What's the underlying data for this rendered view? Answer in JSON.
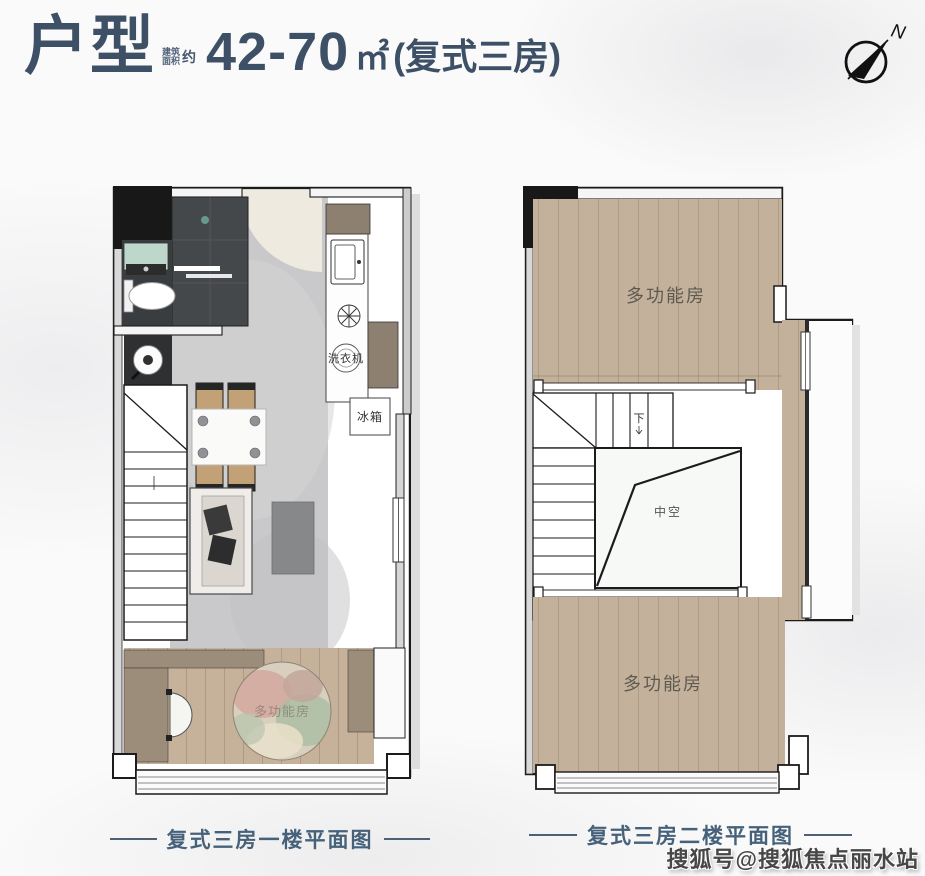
{
  "header": {
    "title": "户型",
    "area_label_line1": "建筑",
    "area_label_line2": "面积",
    "area_approx": "约",
    "area_value": "42-70",
    "area_unit": "㎡",
    "area_suffix": "(复式三房)"
  },
  "compass": {
    "north_label": "N"
  },
  "plans": {
    "first_floor": {
      "caption": "复式三房一楼平面图",
      "labels": {
        "washing_machine": "洗衣机",
        "fridge": "冰箱",
        "multi_room": "多功能房"
      }
    },
    "second_floor": {
      "caption": "复式三房二楼平面图",
      "labels": {
        "multi_room_top": "多功能房",
        "multi_room_bottom": "多功能房",
        "void": "中空",
        "down": "下"
      }
    }
  },
  "watermark": "搜狐号@搜狐焦点丽水站",
  "colors": {
    "title": "#3d5066",
    "caption": "#46617a",
    "wall": "#1b1b1b",
    "wood": "#c4b19b",
    "floor_gray": "#c9c9cb",
    "cabinet_brown": "#9c8d7b",
    "bathroom_dark": "#45484b",
    "sink_mint": "#bdd8ca"
  }
}
